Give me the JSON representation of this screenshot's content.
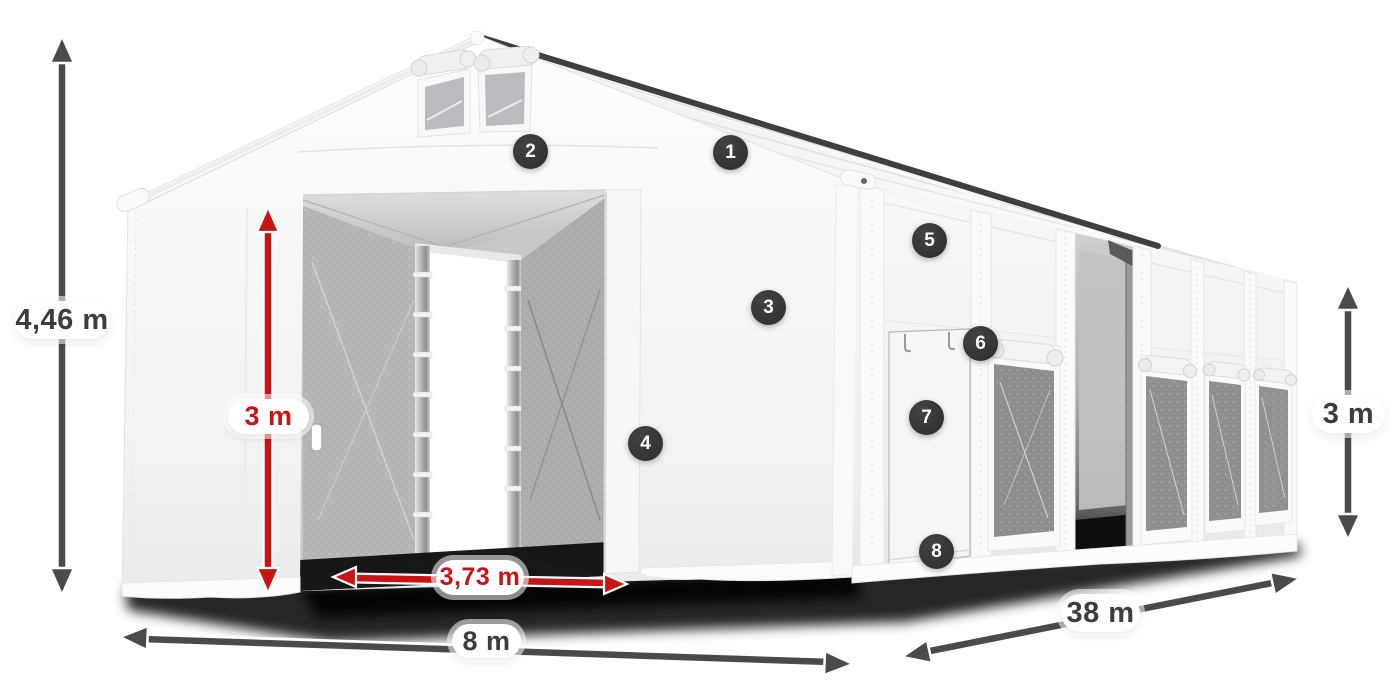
{
  "diagram": {
    "subject": "White storage tent with dimension annotations",
    "dimensions": {
      "total_height": "4,46 m",
      "entrance_height": "3 m",
      "entrance_width": "3,73 m",
      "tent_width": "8 m",
      "tent_length": "38 m",
      "side_wall_height": "3 m"
    },
    "markers": [
      {
        "label": "1"
      },
      {
        "label": "2"
      },
      {
        "label": "3"
      },
      {
        "label": "4"
      },
      {
        "label": "5"
      },
      {
        "label": "6"
      },
      {
        "label": "7"
      },
      {
        "label": "8"
      }
    ],
    "colors": {
      "dimension_red": "#c81414",
      "dimension_dark": "#4a4a4a",
      "marker_badge_bg": "#333333",
      "tent_surface": "#f4f4f4",
      "mesh_gray": "#b4b4b4",
      "background": "#ffffff"
    }
  }
}
